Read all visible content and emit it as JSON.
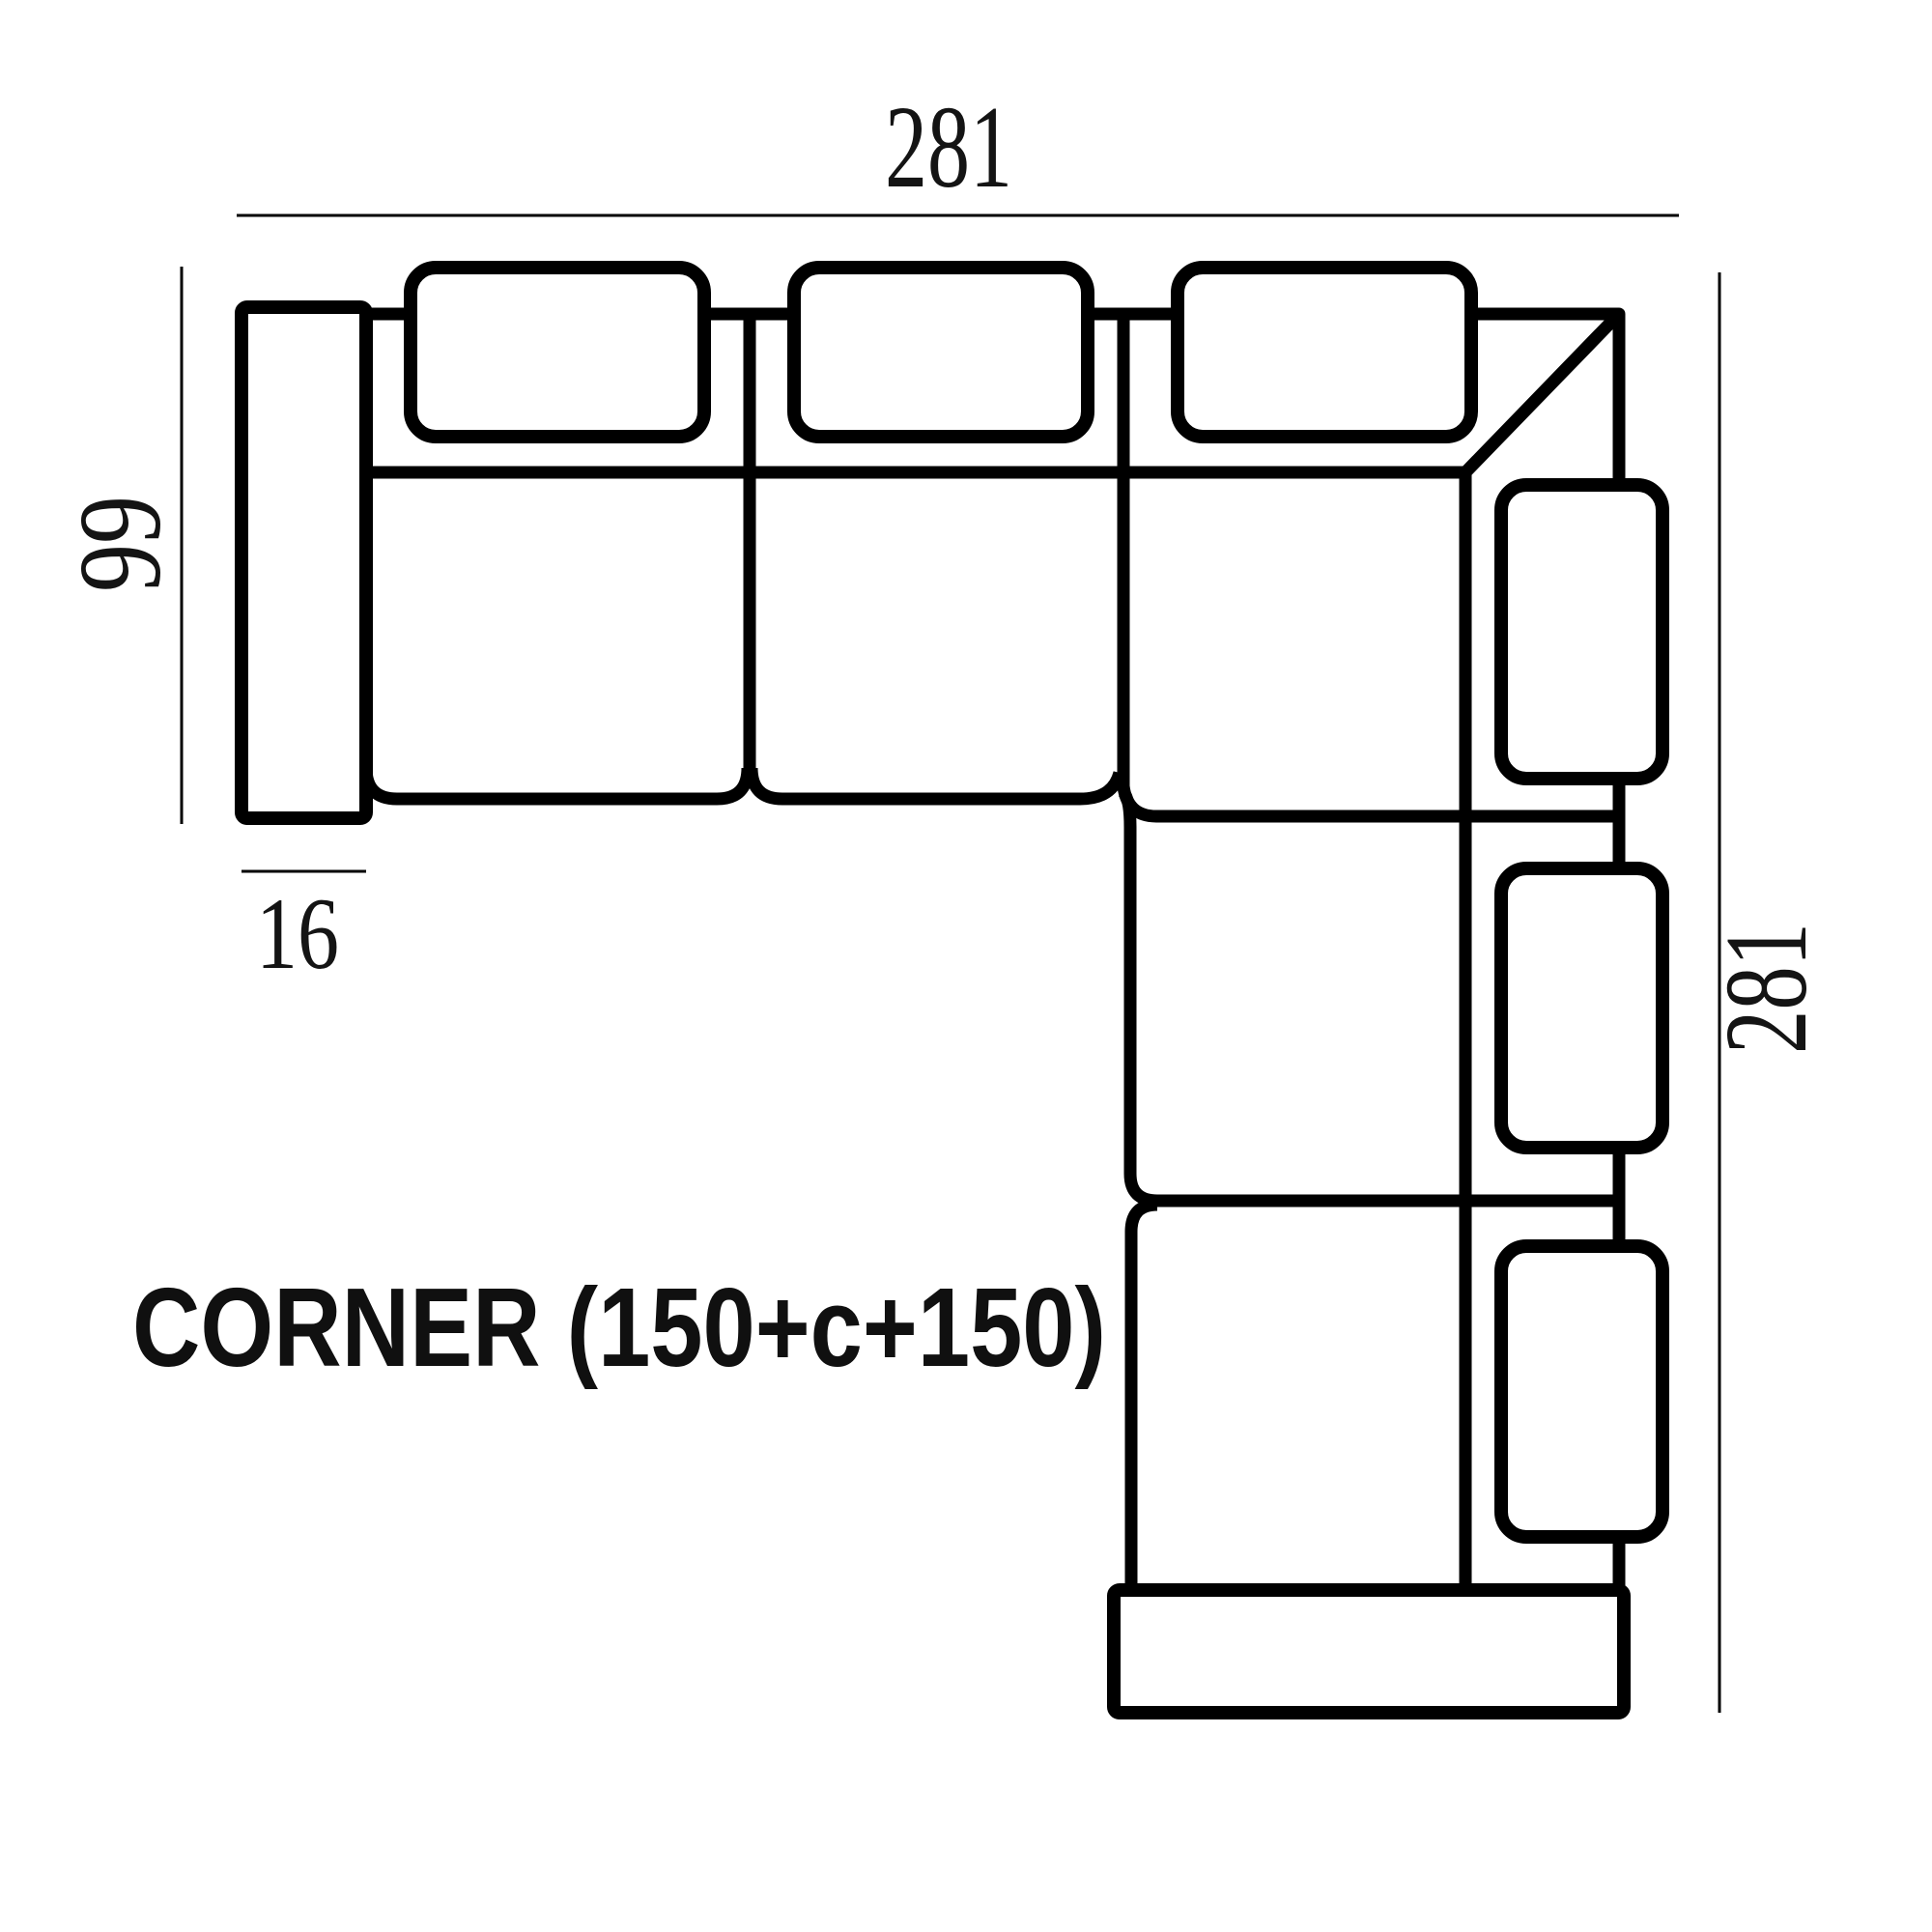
{
  "page": {
    "background_color": "#ffffff",
    "line_color": "#000000",
    "label_color": "#141414"
  },
  "diagram": {
    "title": "CORNER (150+c+150)",
    "dimensions": {
      "overall_width": "281",
      "left_depth": "99",
      "armrest_width": "16",
      "overall_length": "281"
    }
  }
}
